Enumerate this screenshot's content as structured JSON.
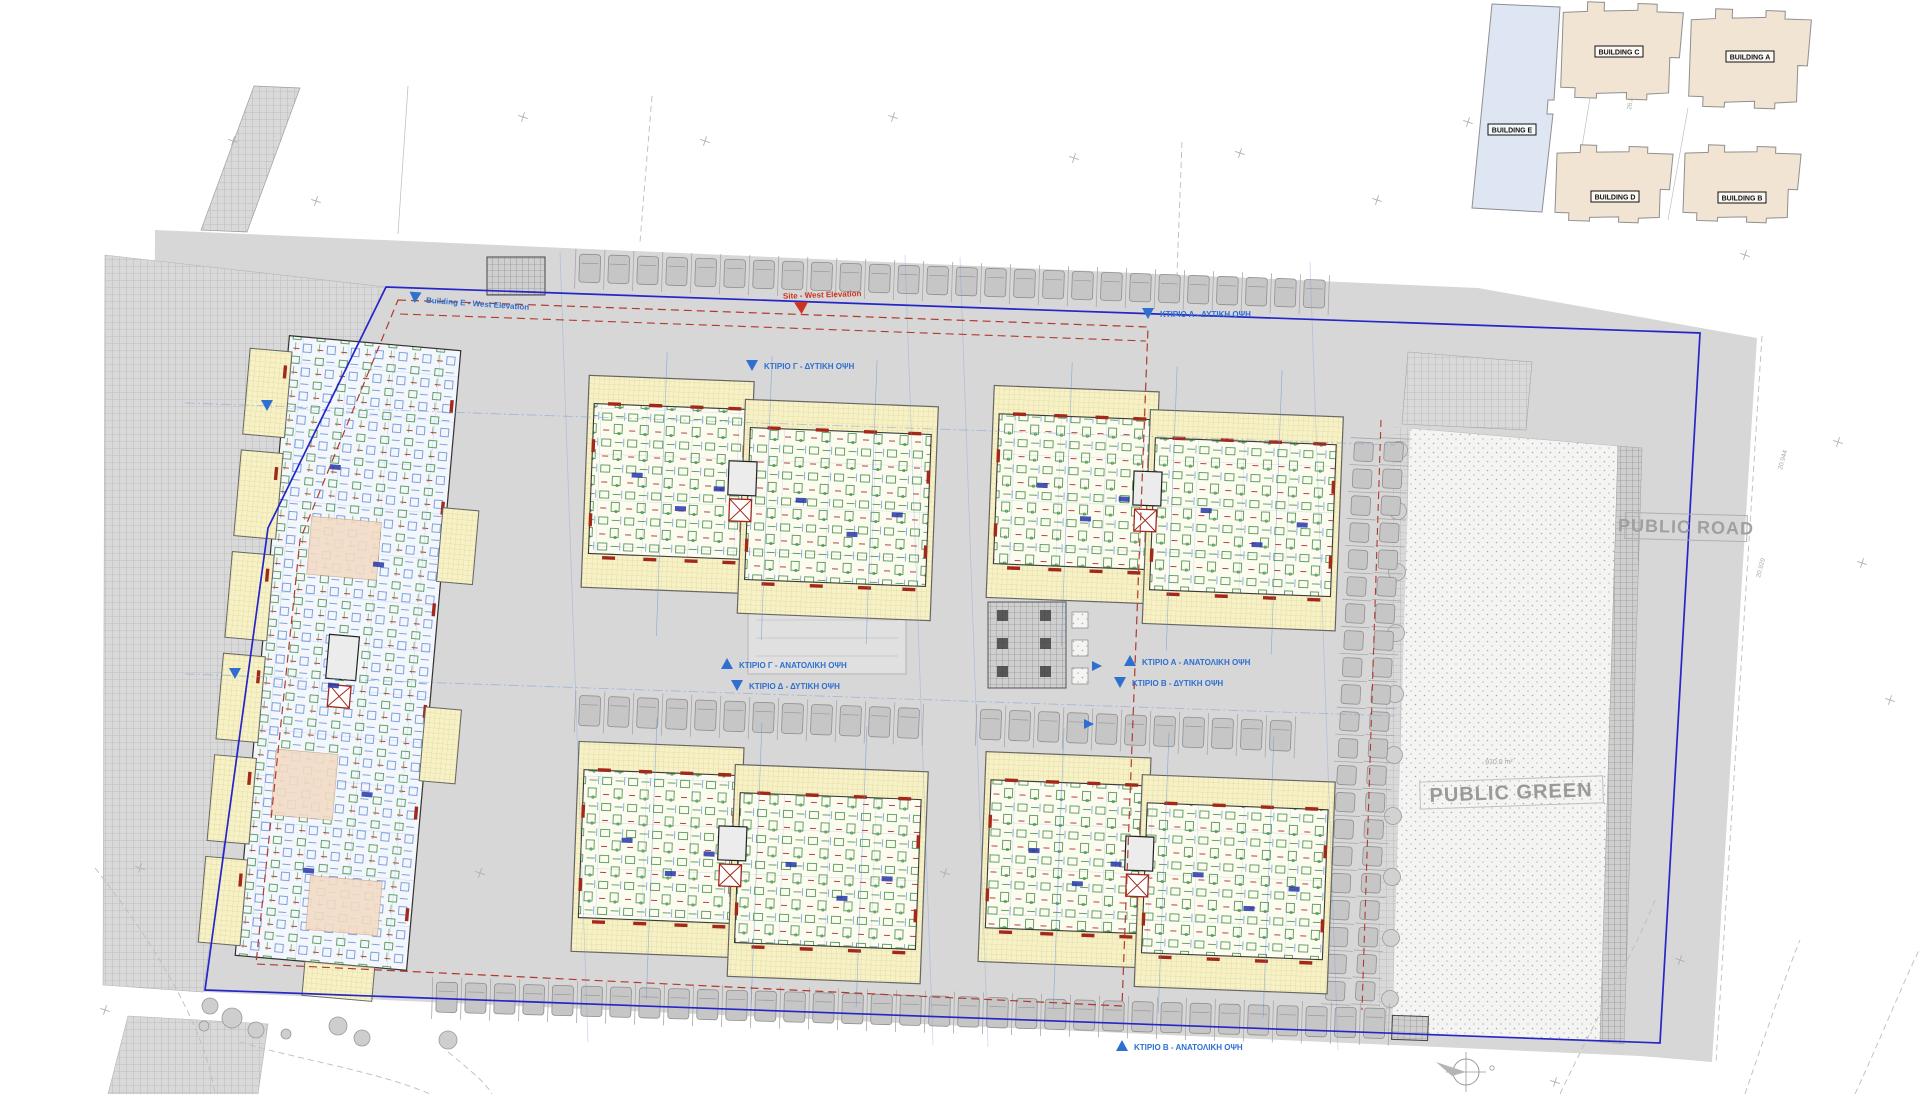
{
  "key_plan": {
    "buildings": [
      {
        "id": "building-c",
        "label": "BUILDING C"
      },
      {
        "id": "building-a",
        "label": "BUILDING A"
      },
      {
        "id": "building-e",
        "label": "BUILDING E"
      },
      {
        "id": "building-d",
        "label": "BUILDING D"
      },
      {
        "id": "building-b",
        "label": "BUILDING B"
      }
    ]
  },
  "site_plan": {
    "road_label": "PUBLIC ROAD",
    "green_label": "PUBLIC GREEN",
    "green_area_label": "970.0 m²",
    "site_marker": {
      "label": "Site - West Elevation"
    },
    "elevation_markers": [
      {
        "id": "e-west",
        "label": "Building E - West Elevation",
        "dir": "down"
      },
      {
        "id": "c-west",
        "label": "ΚΤΙΡΙΟ Γ - ΔΥΤΙΚΗ ΟΨΗ",
        "dir": "down"
      },
      {
        "id": "a-west",
        "label": "ΚΤΙΡΙΟ Α - ΔΥΤΙΚΗ ΟΨΗ",
        "dir": "down"
      },
      {
        "id": "c-east",
        "label": "ΚΤΙΡΙΟ Γ - ΑΝΑΤΟΛΙΚΗ ΟΨΗ",
        "dir": "up"
      },
      {
        "id": "d-west",
        "label": "ΚΤΙΡΙΟ Δ - ΔΥΤΙΚΗ ΟΨΗ",
        "dir": "down"
      },
      {
        "id": "a-east",
        "label": "ΚΤΙΡΙΟ Α - ΑΝΑΤΟΛΙΚΗ ΟΨΗ",
        "dir": "up"
      },
      {
        "id": "b-west",
        "label": "ΚΤΙΡΙΟ Β - ΔΥΤΙΚΗ ΟΨΗ",
        "dir": "down"
      },
      {
        "id": "b-east",
        "label": "ΚΤΙΡΙΟ Β - ΑΝΑΤΟΛΙΚΗ ΟΨΗ",
        "dir": "up"
      }
    ],
    "spot_elevations": [
      "20.944",
      "20.929",
      "26.872",
      "20.281"
    ],
    "parking": {
      "rows": [
        {
          "id": "north-row",
          "count": 26
        },
        {
          "id": "mid-west-row",
          "count": 12
        },
        {
          "id": "mid-east-row",
          "count": 11
        },
        {
          "id": "south-row",
          "count": 33
        },
        {
          "id": "east-col-inner",
          "count": 21
        },
        {
          "id": "east-col-outer",
          "count": 21
        }
      ]
    }
  },
  "colors": {
    "boundary_blue": "#2525c8",
    "setback_red": "#b03a2e",
    "marker_blue": "#2e6fd0",
    "marker_red": "#cc3322",
    "keyplan_tan": "#f2e4d2",
    "keyplan_blue": "#dde6f2",
    "veranda_yellow": "#f7f1c8",
    "plan_cream": "#fcfbef",
    "road_gray": "#d7d7d7",
    "label_gray": "#9d9d9d"
  }
}
